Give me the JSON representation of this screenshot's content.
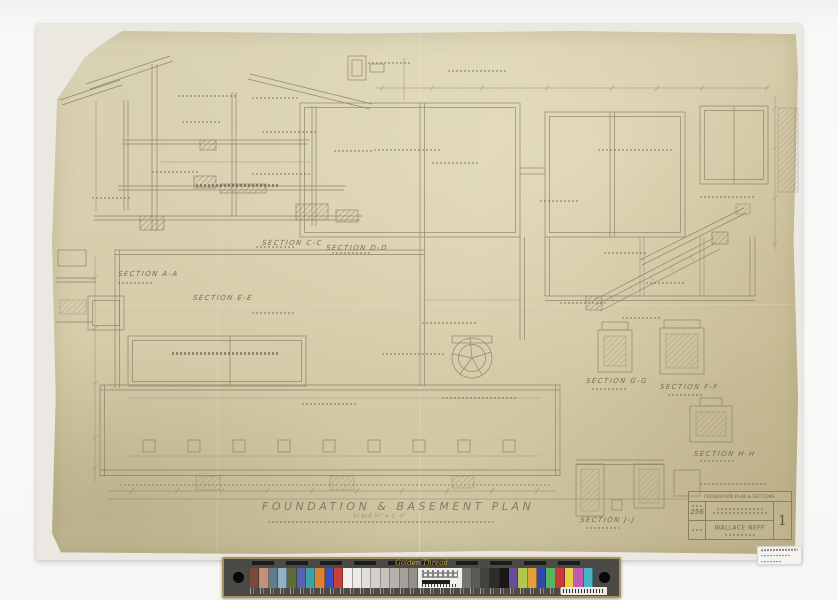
{
  "scan": {
    "title": "FOUNDATION & BASEMENT PLAN",
    "scale_note": "SCALE  ¼\" = 1'-0\"",
    "section_labels": [
      {
        "text": "SECTION A-A"
      },
      {
        "text": "SECTION E-E"
      },
      {
        "text": "SECTION C-C"
      },
      {
        "text": "SECTION D-D"
      },
      {
        "text": "SECTION G-G"
      },
      {
        "text": "SECTION F-F"
      },
      {
        "text": "SECTION H-H"
      },
      {
        "text": "SECTION J-J"
      }
    ],
    "title_block": {
      "header": "FOUNDATION PLAN & SECTIONS",
      "job_number": "256",
      "architect": "WALLACE NEFF",
      "sheet_number": "1"
    },
    "palette": {
      "paper": "#d6cdaa",
      "pencil": "#837a64",
      "background": "#f6f6f5"
    }
  },
  "color_bar": {
    "brand": "Golden Thread",
    "left_patches": [
      "#7a4b38",
      "#c2917b",
      "#5b7f8c",
      "#8fb2c4",
      "#5d6b3d",
      "#5a62b4",
      "#3fa3a4",
      "#df8133",
      "#3a50bd",
      "#c93f39"
    ],
    "gray_ramp": [
      "#f2f0e9",
      "#eceae3",
      "#e0ded7",
      "#d3d1ca",
      "#c5c3bc",
      "#b5b3ac",
      "#a3a19a",
      "#918f89"
    ],
    "dark_ramp": [
      "#77756f",
      "#5d5b56",
      "#44433f",
      "#2e2d2a",
      "#181816"
    ],
    "right_patches": [
      "#6b4b9d",
      "#b1c84e",
      "#dfa23b",
      "#3446b0",
      "#57b25c",
      "#c7393c",
      "#e3cf43",
      "#bf5cb0",
      "#4ab3c6"
    ]
  }
}
